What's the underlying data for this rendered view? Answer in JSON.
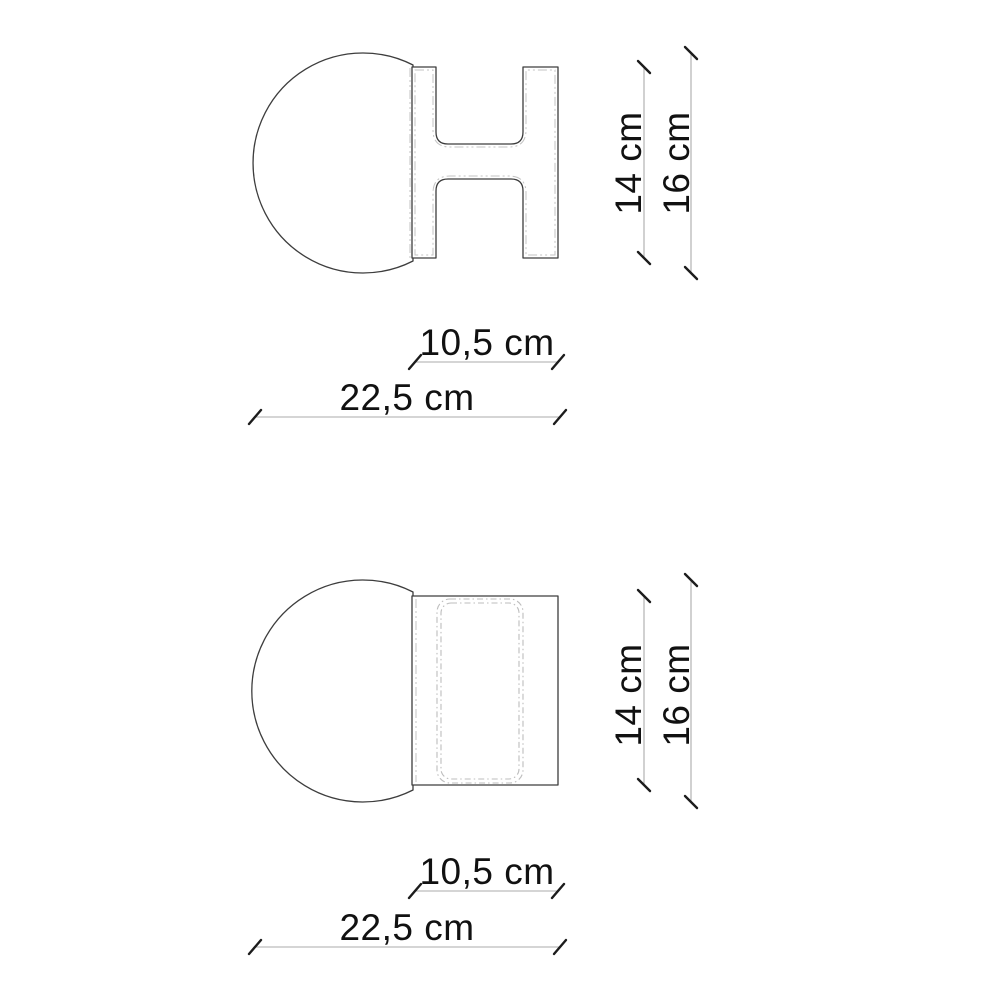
{
  "drawing": {
    "colors": {
      "background": "#ffffff",
      "outline": "#3d3d3d",
      "phantom_line": "#c3c3c3",
      "dimension_line": "#ababab",
      "dimension_text": "#111111"
    },
    "side_view": {
      "bracket_height": "14 cm",
      "total_height": "16 cm",
      "bracket_width": "10,5 cm",
      "total_width": "22,5 cm"
    },
    "front_view": {
      "bracket_height": "14 cm",
      "total_height": "16 cm",
      "bracket_width": "10,5 cm",
      "total_width": "22,5 cm"
    }
  }
}
